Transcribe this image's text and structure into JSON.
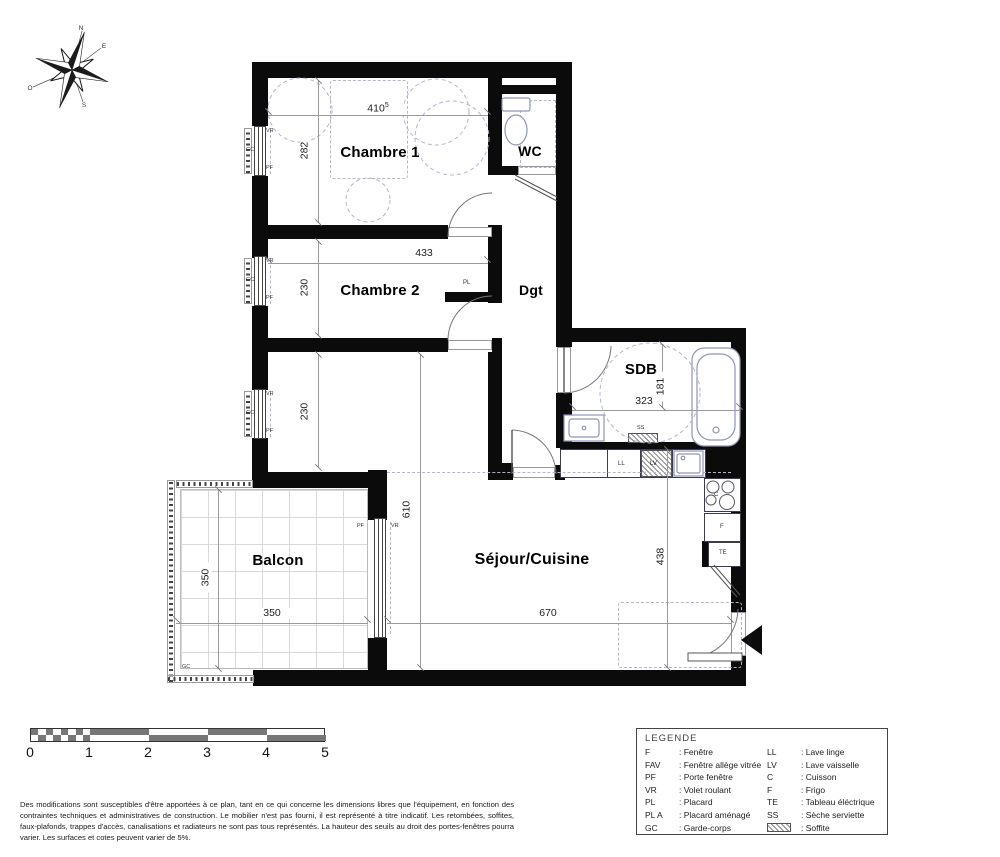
{
  "plan": {
    "rooms": {
      "chambre1": "Chambre 1",
      "chambre2": "Chambre 2",
      "wc": "WC",
      "dgt": "Dgt",
      "sdb": "SDB",
      "sejour": "Séjour/Cuisine",
      "balcon": "Balcon"
    },
    "dims": {
      "ch1_w": "410",
      "ch1_w_sup": "5",
      "ch1_h": "282",
      "ch2_w": "433",
      "ch2_h": "230",
      "alcove_h": "230",
      "sdb_w": "323",
      "sdb_h": "181",
      "sejour_h": "610",
      "sejour_w": "670",
      "kitchen_h": "438",
      "balcon_w": "350",
      "balcon_h": "350"
    },
    "tags": {
      "vr": "VR",
      "gc": "GC",
      "pf": "PF",
      "pl": "PL",
      "ss": "SS",
      "ll": "LL",
      "lv": "LV",
      "c": "C",
      "f": "F",
      "te": "TE"
    }
  },
  "compass": {
    "n": "N",
    "e": "E",
    "s": "S",
    "w": "O"
  },
  "scalebar": {
    "ticks": [
      "0",
      "1",
      "2",
      "3",
      "4",
      "5"
    ]
  },
  "legend": {
    "title": "LEGENDE",
    "left": [
      {
        "abbr": "F",
        "label": "Fenêtre"
      },
      {
        "abbr": "FAV",
        "label": "Fenêtre allège vitrée"
      },
      {
        "abbr": "PF",
        "label": "Porte fenêtre"
      },
      {
        "abbr": "VR",
        "label": "Volet roulant"
      },
      {
        "abbr": "PL",
        "label": "Placard"
      },
      {
        "abbr": "PL A",
        "label": "Placard aménagé"
      },
      {
        "abbr": "GC",
        "label": "Garde-corps"
      }
    ],
    "right": [
      {
        "abbr": "LL",
        "label": "Lave linge"
      },
      {
        "abbr": "LV",
        "label": "Lave vaisselle"
      },
      {
        "abbr": "C",
        "label": "Cuisson"
      },
      {
        "abbr": "F",
        "label": "Frigo"
      },
      {
        "abbr": "TE",
        "label": "Tableau éléctrique"
      },
      {
        "abbr": "SS",
        "label": "Sèche serviette"
      },
      {
        "abbr": "",
        "swatch": true,
        "label": "Soffite"
      }
    ]
  },
  "disclaimer": "Des modifications sont susceptibles d'être apportées à ce plan, tant en ce qui concerne les dimensions libres que l'équipement, en fonction des contraintes techniques et administratives de construction. Le mobilier n'est pas fourni, il est représenté à titre indicatif. Les retombées, soffites, faux-plafonds, trappes d'accès, canalisations et radiateurs ne sont pas tous représentés. La hauteur des seuils au droit des portes-fenêtres pourra varier. Les surfaces et cotes peuvent varier de 5%.",
  "colors": {
    "wall": "#0b0b0b",
    "fixture": "#8f93b8",
    "dashed": "#b4b4d2",
    "dimension": "#9a9a9a"
  }
}
